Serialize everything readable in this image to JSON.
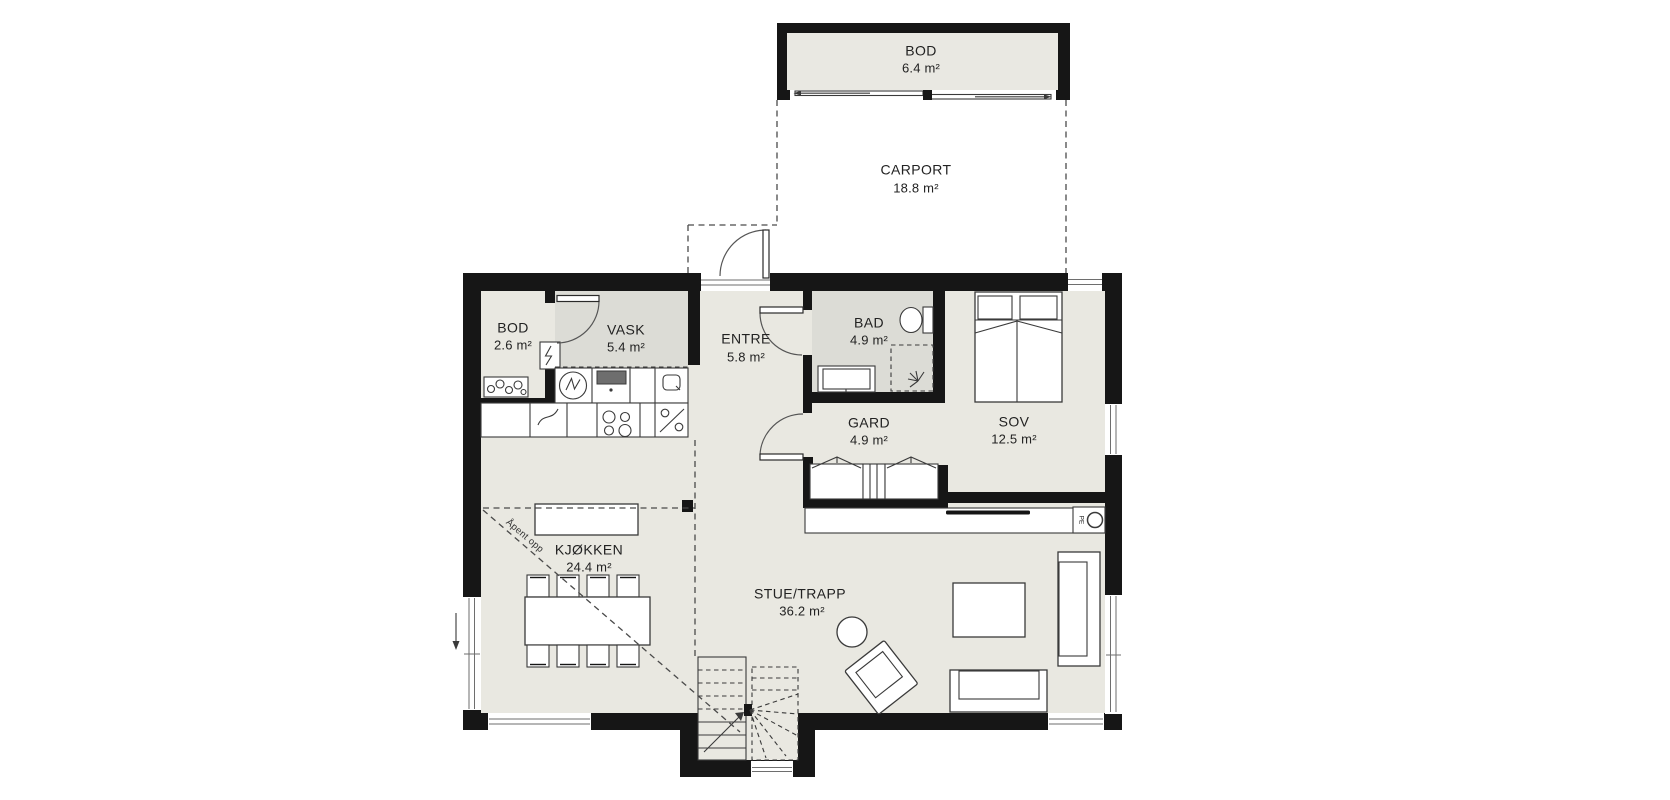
{
  "plan": {
    "labels": {
      "bod_top": {
        "name": "BOD",
        "area": "6.4 m²"
      },
      "carport": {
        "name": "CARPORT",
        "area": "18.8 m²"
      },
      "bod": {
        "name": "BOD",
        "area": "2.6 m²"
      },
      "vask": {
        "name": "VASK",
        "area": "5.4 m²"
      },
      "entre": {
        "name": "ENTRE",
        "area": "5.8 m²"
      },
      "bad": {
        "name": "BAD",
        "area": "4.9 m²"
      },
      "gard": {
        "name": "GARD",
        "area": "4.9 m²"
      },
      "sov": {
        "name": "SOV",
        "area": "12.5 m²"
      },
      "kjokken": {
        "name": "KJØKKEN",
        "area": "24.4 m²"
      },
      "stue": {
        "name": "STUE/TRAPP",
        "area": "36.2 m²"
      }
    },
    "annotations": {
      "open_above": "Åpent opp",
      "fireplace": "PE"
    },
    "colors": {
      "wall": "#161616",
      "floor": "#e9e8e1",
      "wet_room_floor": "#dcdcd6",
      "background": "#ffffff"
    }
  }
}
